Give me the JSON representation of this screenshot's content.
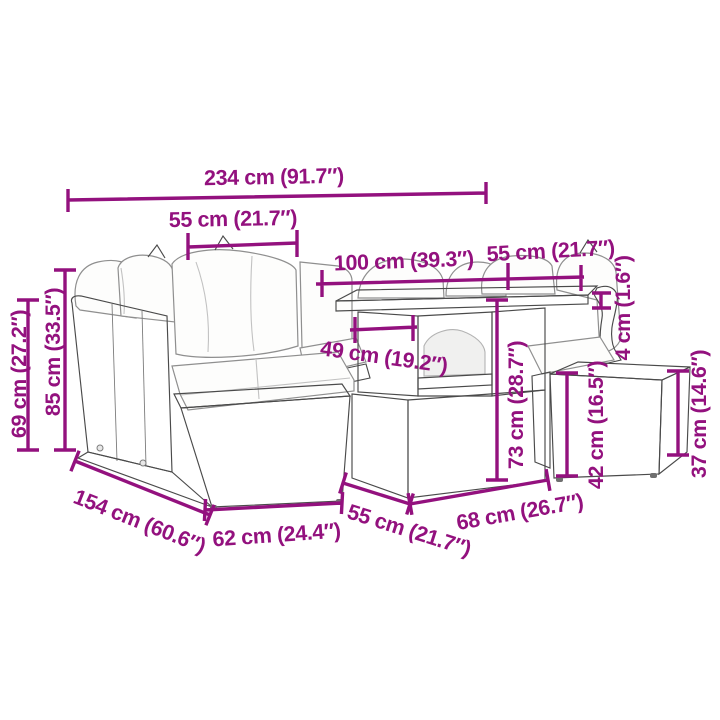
{
  "diagram": {
    "type": "furniture-dimension-diagram",
    "subject": "7-piece poly rattan garden lounge set with corner sofa, glass-top table, chair and footstool",
    "colors": {
      "dimension": "#93117E",
      "outline": "#4a4a4a",
      "weave": "#8f8f8f",
      "weave_bg": "#f3f3f2",
      "cushion": "#fdfdfc",
      "glass": "#ebebea",
      "background": "#ffffff"
    }
  },
  "measurements": {
    "m234": {
      "label": "234 cm (91.7″)",
      "role": "total-width"
    },
    "m55tl": {
      "label": "55 cm (21.7″)",
      "role": "left-seat-width"
    },
    "m100": {
      "label": "100 cm (39.3″)",
      "role": "table-length"
    },
    "m55tr": {
      "label": "55 cm (21.7″)",
      "role": "right-seat-width"
    },
    "m49": {
      "label": "49 cm (19.2″)",
      "role": "shelf-width"
    },
    "m69": {
      "label": "69 cm (27.2″)",
      "role": "back-height"
    },
    "m85": {
      "label": "85 cm (33.5″)",
      "role": "total-height"
    },
    "m73": {
      "label": "73 cm (28.7″)",
      "role": "table-height"
    },
    "m4": {
      "label": "4 cm (1.6″)",
      "role": "tabletop-thickness"
    },
    "m42": {
      "label": "42 cm (16.5″)",
      "role": "seat-height"
    },
    "m37": {
      "label": "37 cm (14.6″)",
      "role": "footstool-height"
    },
    "m154": {
      "label": "154 cm (60.6″)",
      "role": "total-depth"
    },
    "m62": {
      "label": "62 cm (24.4″)",
      "role": "sofa-front-width"
    },
    "m55b": {
      "label": "55 cm (21.7″)",
      "role": "table-depth"
    },
    "m68": {
      "label": "68 cm (26.7″)",
      "role": "table-base-width"
    }
  }
}
